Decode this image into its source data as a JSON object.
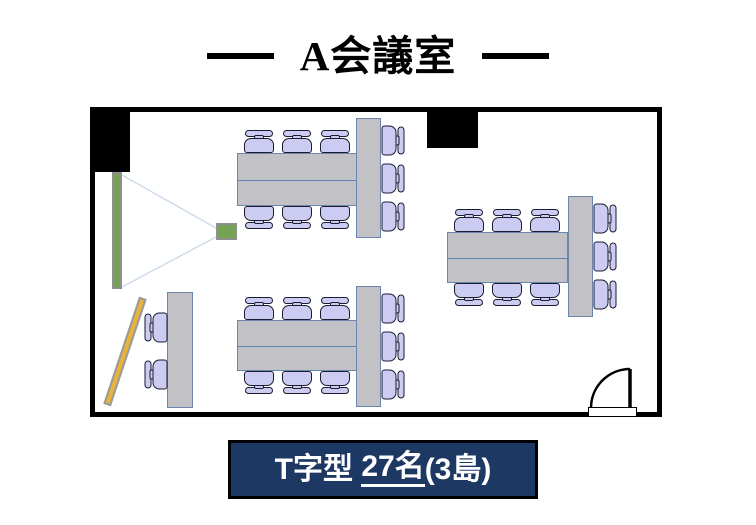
{
  "title": {
    "text": "A会議室"
  },
  "caption": {
    "part1": "T字型 ",
    "part2": "27名",
    "part3": "(3島)",
    "box": {
      "x": 228,
      "y": 440,
      "w": 304,
      "h": 53
    }
  },
  "colors": {
    "wall": "#000000",
    "table_fill": "#c1c1c6",
    "table_border": "#6b87ad",
    "table_divider": "#5d83b6",
    "chair_fill": "#ccccf2",
    "chair_outline": "#1a1a30",
    "screen_green": "#76a254",
    "board_orange": "#e9b33b",
    "beam_blue": "#c9d9ec",
    "caption_bg": "#1e3864",
    "caption_text": "#ffffff"
  },
  "floorplan": {
    "room": {
      "x": 90,
      "y": 107,
      "w": 572,
      "h": 310,
      "wall": 5
    },
    "pillars": [
      {
        "x": 93,
        "y": 110,
        "w": 37,
        "h": 62
      },
      {
        "x": 427,
        "y": 111,
        "w": 51,
        "h": 37
      }
    ],
    "screen": {
      "x": 112,
      "y": 172,
      "w": 10,
      "h": 117
    },
    "projector": {
      "x": 216,
      "y": 223,
      "w": 21,
      "h": 17
    },
    "beams": [
      {
        "x1": 122,
        "y1": 175,
        "x2": 216,
        "y2": 228
      },
      {
        "x1": 122,
        "y1": 287,
        "x2": 216,
        "y2": 237
      }
    ],
    "whiteboard": {
      "cx": 125,
      "cy": 351,
      "w": 8,
      "len": 113,
      "angle": 18.5
    },
    "side_table": {
      "x": 167,
      "y": 292,
      "w": 26,
      "h": 116
    },
    "side_chair_centers_y": [
      327,
      374
    ],
    "chair_offsets": [
      22,
      60,
      98
    ],
    "islands": [
      {
        "h": {
          "x": 237,
          "y": 153,
          "w": 120,
          "h": 53
        },
        "v": {
          "x": 356,
          "y": 118,
          "w": 25,
          "h": 120
        }
      },
      {
        "h": {
          "x": 447,
          "y": 232,
          "w": 121,
          "h": 51
        },
        "v": {
          "x": 568,
          "y": 196,
          "w": 25,
          "h": 121
        }
      },
      {
        "h": {
          "x": 237,
          "y": 320,
          "w": 120,
          "h": 51
        },
        "v": {
          "x": 356,
          "y": 286,
          "w": 25,
          "h": 121
        }
      }
    ],
    "door": {
      "hinge_x": 630,
      "hinge_y": 408,
      "radius": 39,
      "threshold": {
        "x": 588,
        "y": 407,
        "w": 49,
        "h": 10
      }
    }
  }
}
